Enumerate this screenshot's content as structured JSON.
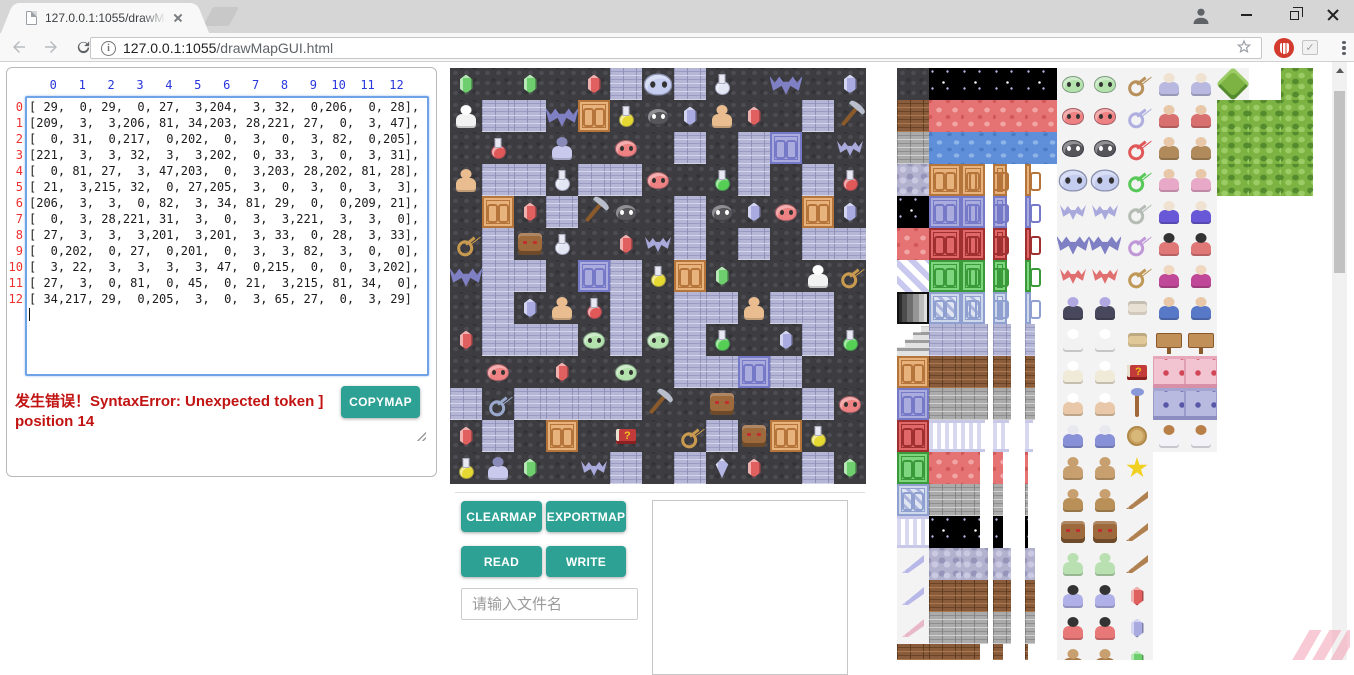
{
  "browser": {
    "tab_title": "127.0.0.1:1055/drawMa",
    "url_host": "127.0.0.1:1055",
    "url_path": "/drawMapGUI.html"
  },
  "left_panel": {
    "col_headers": [
      0,
      1,
      2,
      3,
      4,
      5,
      6,
      7,
      8,
      9,
      10,
      11,
      12
    ],
    "row_headers": [
      0,
      1,
      2,
      3,
      4,
      5,
      6,
      7,
      8,
      9,
      10,
      11,
      12
    ],
    "error_text": "发生错误！SyntaxError: Unexpected token ] position 14",
    "copymap_label": "COPYMAP"
  },
  "controls": {
    "clearmap_label": "CLEARMAP",
    "exportmap_label": "EXPORTMAP",
    "read_label": "READ",
    "write_label": "WRITE",
    "filename_placeholder": "请输入文件名"
  },
  "colors": {
    "accent_teal": "#2ea195",
    "error_red": "#c21313",
    "col_header_blue": "#2936dd",
    "row_header_red": "#ee2f2f"
  },
  "map": {
    "matrix": [
      [
        29,
        0,
        29,
        0,
        27,
        3,
        204,
        3,
        32,
        0,
        206,
        0,
        28
      ],
      [
        209,
        3,
        3,
        206,
        81,
        34,
        203,
        28,
        221,
        27,
        0,
        3,
        47
      ],
      [
        0,
        31,
        0,
        217,
        0,
        202,
        0,
        3,
        0,
        3,
        82,
        0,
        205
      ],
      [
        221,
        3,
        3,
        32,
        3,
        3,
        202,
        0,
        33,
        3,
        0,
        3,
        31
      ],
      [
        0,
        81,
        27,
        3,
        47,
        203,
        0,
        3,
        203,
        28,
        202,
        81,
        28
      ],
      [
        21,
        3,
        215,
        32,
        0,
        27,
        205,
        3,
        0,
        3,
        0,
        3,
        3
      ],
      [
        206,
        3,
        3,
        0,
        82,
        3,
        34,
        81,
        29,
        0,
        0,
        209,
        21
      ],
      [
        0,
        3,
        28,
        221,
        31,
        3,
        0,
        3,
        3,
        221,
        3,
        3,
        0
      ],
      [
        27,
        3,
        3,
        3,
        201,
        3,
        201,
        3,
        33,
        0,
        28,
        3,
        33
      ],
      [
        0,
        202,
        0,
        27,
        0,
        201,
        0,
        3,
        3,
        82,
        3,
        0,
        0
      ],
      [
        3,
        22,
        3,
        3,
        3,
        3,
        47,
        0,
        215,
        0,
        0,
        3,
        202
      ],
      [
        27,
        3,
        0,
        81,
        0,
        45,
        0,
        21,
        3,
        215,
        81,
        34,
        0
      ],
      [
        34,
        217,
        29,
        0,
        205,
        3,
        0,
        3,
        65,
        27,
        0,
        3,
        29
      ]
    ],
    "legend": {
      "0": {
        "g": "floor",
        "name": "dark-floor"
      },
      "3": {
        "g": "wall",
        "name": "brick-wall"
      },
      "21": {
        "s": "key",
        "c": "#c89a50",
        "name": "yellow-key"
      },
      "22": {
        "s": "key",
        "c": "#9aa8cc",
        "name": "blue-key"
      },
      "27": {
        "s": "gem",
        "c": "#e06060",
        "name": "red-gem"
      },
      "28": {
        "s": "gem",
        "c": "#a8aae0",
        "name": "blue-gem"
      },
      "29": {
        "s": "gem",
        "c": "#6ece6e",
        "name": "green-gem"
      },
      "31": {
        "s": "flask",
        "c": "#e05858",
        "name": "red-potion"
      },
      "32": {
        "s": "flask",
        "c": "#e3e7f4",
        "name": "silver-potion"
      },
      "33": {
        "s": "flask",
        "c": "#55d055",
        "name": "green-potion"
      },
      "34": {
        "s": "flask",
        "c": "#e6d832",
        "name": "yellow-potion"
      },
      "45": {
        "s": "book",
        "name": "magic-book"
      },
      "47": {
        "s": "pick",
        "name": "pickaxe"
      },
      "65": {
        "s": "top",
        "c": "#b4b6e4",
        "name": "spinner-item"
      },
      "81": {
        "d": "tan",
        "name": "orange-door"
      },
      "82": {
        "d": "lav",
        "name": "blue-door"
      },
      "201": {
        "s": "slime",
        "c": "#b4e2ac",
        "e": "#333333",
        "name": "green-slime"
      },
      "202": {
        "s": "slime",
        "c": "#ee8282",
        "e": "#333333",
        "name": "red-slime"
      },
      "203": {
        "s": "slime",
        "c": "#55555a",
        "e": "#ffffff",
        "name": "black-slime"
      },
      "204": {
        "s": "slime",
        "c": "#c4cdf0",
        "e": "#333333",
        "big": 1,
        "name": "big-slime"
      },
      "205": {
        "s": "bat",
        "c": "#a9a9dc",
        "name": "small-bat"
      },
      "206": {
        "s": "bat",
        "c": "#7f7fc4",
        "big": 1,
        "name": "big-bat"
      },
      "209": {
        "s": "person",
        "c": "#f2f2f2",
        "h": "#ffffff",
        "name": "skeleton"
      },
      "215": {
        "s": "face",
        "c": "#9c6a3c",
        "name": "stone-statue"
      },
      "217": {
        "s": "person",
        "c": "#c9c9ee",
        "h": "#8a8ab8",
        "name": "ghost"
      },
      "221": {
        "s": "person",
        "c": "#e9bd8f",
        "h": "#e9bd8f",
        "name": "golem"
      }
    }
  },
  "tileset": {
    "rows": [
      [
        {
          "g": "floor"
        },
        {
          "g": "black"
        },
        {
          "g": "black"
        },
        {
          "g": "black"
        },
        {
          "g": "black"
        },
        {
          "s": "slime",
          "c": "#b4e2ac",
          "e": "#333333"
        },
        {
          "s": "slime",
          "c": "#b4e2ac",
          "e": "#333333"
        },
        {
          "s": "key",
          "c": "#b8905a"
        },
        {
          "s": "person",
          "c": "#b8b8e0",
          "h": "#f0e2d0"
        },
        {
          "s": "person",
          "c": "#b8b8e0",
          "h": "#f0e2d0"
        },
        {
          "s": "treeD"
        },
        null,
        {
          "g": "tree"
        }
      ],
      [
        {
          "g": "bbrick"
        },
        {
          "g": "red"
        },
        {
          "g": "red"
        },
        {
          "g": "red"
        },
        {
          "g": "red"
        },
        {
          "s": "slime",
          "c": "#ee8282",
          "e": "#333333"
        },
        {
          "s": "slime",
          "c": "#ee8282",
          "e": "#333333"
        },
        {
          "s": "key",
          "c": "#b0b0e0"
        },
        {
          "s": "person",
          "c": "#d87070",
          "h": "#e8c8a8"
        },
        {
          "s": "person",
          "c": "#d87070",
          "h": "#e8c8a8"
        },
        {
          "g": "tree"
        },
        {
          "g": "tree"
        },
        {
          "g": "tree"
        }
      ],
      [
        {
          "g": "gstone"
        },
        {
          "g": "water"
        },
        {
          "g": "water"
        },
        {
          "g": "water"
        },
        {
          "g": "water"
        },
        {
          "s": "slime",
          "c": "#55555a",
          "e": "#ffffff"
        },
        {
          "s": "slime",
          "c": "#55555a",
          "e": "#ffffff"
        },
        {
          "s": "key",
          "c": "#e05858"
        },
        {
          "s": "person",
          "c": "#b08a5a",
          "h": "#e8c8a8"
        },
        {
          "s": "person",
          "c": "#b08a5a",
          "h": "#e8c8a8"
        },
        {
          "g": "tree"
        },
        {
          "g": "tree"
        },
        {
          "g": "tree"
        }
      ],
      [
        {
          "g": "lavcob"
        },
        {
          "d": "tan"
        },
        {
          "d": "tan",
          "f": 75
        },
        {
          "d": "tan",
          "f": 45
        },
        {
          "d": "tan",
          "f": 18
        },
        {
          "s": "slime",
          "c": "#c4cdf0",
          "e": "#333333",
          "big": 1
        },
        {
          "s": "slime",
          "c": "#c4cdf0",
          "e": "#333333",
          "big": 1
        },
        {
          "s": "key",
          "c": "#58c858"
        },
        {
          "s": "person",
          "c": "#e8a8c8",
          "h": "#e8c8a8"
        },
        {
          "s": "person",
          "c": "#e8a8c8",
          "h": "#e8c8a8"
        },
        {
          "g": "tree"
        },
        {
          "g": "tree"
        },
        {
          "g": "tree"
        }
      ],
      [
        {
          "g": "black"
        },
        {
          "d": "lav"
        },
        {
          "d": "lav",
          "f": 75
        },
        {
          "d": "lav",
          "f": 45
        },
        {
          "d": "lav",
          "f": 18
        },
        {
          "s": "bat",
          "c": "#a9a9dc"
        },
        {
          "s": "bat",
          "c": "#a9a9dc"
        },
        {
          "s": "key",
          "c": "#b4bcb4"
        },
        {
          "s": "person",
          "c": "#6858d8",
          "h": "#f0e2d0"
        },
        {
          "s": "person",
          "c": "#6858d8",
          "h": "#f0e2d0"
        },
        null,
        null,
        null
      ],
      [
        {
          "g": "red"
        },
        {
          "d": "red"
        },
        {
          "d": "red",
          "f": 75
        },
        {
          "d": "red",
          "f": 45
        },
        {
          "d": "red",
          "f": 18
        },
        {
          "s": "bat",
          "c": "#7f7fc4",
          "big": 1
        },
        {
          "s": "bat",
          "c": "#7f7fc4",
          "big": 1
        },
        {
          "s": "key",
          "c": "#c098d8"
        },
        {
          "s": "person",
          "c": "#e07878",
          "h": "#333333"
        },
        {
          "s": "person",
          "c": "#e07878",
          "h": "#333333"
        },
        null,
        null,
        null
      ],
      [
        {
          "g": "diag"
        },
        {
          "d": "green"
        },
        {
          "d": "green",
          "f": 75
        },
        {
          "d": "green",
          "f": 45
        },
        {
          "d": "green",
          "f": 18
        },
        {
          "s": "bat",
          "c": "#e07070"
        },
        {
          "s": "bat",
          "c": "#e07070"
        },
        {
          "s": "key",
          "c": "#c09858"
        },
        {
          "s": "person",
          "c": "#c04898",
          "h": "#f0d8c0"
        },
        {
          "s": "person",
          "c": "#c04898",
          "h": "#f0d8c0"
        },
        null,
        null,
        null
      ],
      [
        {
          "g": "fade"
        },
        {
          "d": "lat"
        },
        {
          "d": "lat",
          "f": 75
        },
        {
          "d": "lat",
          "f": 45
        },
        {
          "d": "lat",
          "f": 18
        },
        {
          "s": "person",
          "c": "#48485c",
          "h": "#b0a8e0"
        },
        {
          "s": "person",
          "c": "#48485c",
          "h": "#b0a8e0"
        },
        {
          "s": "scroll",
          "c": "#e8e0d2"
        },
        {
          "s": "person",
          "c": "#5878c8",
          "h": "#e8c8a8"
        },
        {
          "s": "person",
          "c": "#5878c8",
          "h": "#e8c8a8"
        },
        null,
        null,
        null
      ],
      [
        {
          "g": "stairs"
        },
        {
          "g": "wall"
        },
        {
          "g": "wall",
          "f": 85
        },
        {
          "g": "wall",
          "f": 55
        },
        {
          "g": "wall",
          "f": 30
        },
        {
          "s": "person",
          "c": "#f2f2f2",
          "h": "#ffffff"
        },
        {
          "s": "person",
          "c": "#f2f2f2",
          "h": "#ffffff"
        },
        {
          "s": "scroll",
          "c": "#e0c898"
        },
        {
          "s": "sign"
        },
        {
          "s": "sign"
        },
        null,
        null,
        null
      ],
      [
        {
          "d": "tan"
        },
        {
          "g": "bbrick"
        },
        {
          "g": "bbrick",
          "f": 85
        },
        {
          "g": "bbrick",
          "f": 55
        },
        {
          "g": "bbrick",
          "f": 30
        },
        {
          "s": "person",
          "c": "#f0ead8",
          "h": "#ffffff"
        },
        {
          "s": "person",
          "c": "#f0ead8",
          "h": "#ffffff"
        },
        {
          "s": "book"
        },
        {
          "g": "pinkw"
        },
        {
          "g": "pinkw"
        },
        null,
        null,
        null
      ],
      [
        {
          "d": "lav"
        },
        {
          "g": "gstone"
        },
        {
          "g": "gstone",
          "f": 85
        },
        {
          "g": "gstone",
          "f": 55
        },
        {
          "g": "gstone",
          "f": 30
        },
        {
          "s": "person",
          "c": "#e8c8a8",
          "h": "#ffffff"
        },
        {
          "s": "person",
          "c": "#e8c8a8",
          "h": "#ffffff"
        },
        {
          "s": "staff"
        },
        {
          "g": "lavw"
        },
        {
          "g": "lavw"
        },
        null,
        null,
        null
      ],
      [
        {
          "d": "red"
        },
        {
          "g": "pillar"
        },
        {
          "g": "pillar",
          "f": 75
        },
        {
          "g": "pillar",
          "f": 50
        },
        {
          "g": "pillar",
          "f": 25
        },
        {
          "s": "person",
          "c": "#8890d8",
          "h": "#e8e8f0"
        },
        {
          "s": "person",
          "c": "#8890d8",
          "h": "#e8e8f0"
        },
        {
          "s": "medal"
        },
        {
          "s": "person",
          "c": "#f2f2f8",
          "h": "#b88048"
        },
        {
          "s": "person",
          "c": "#f2f2f8",
          "h": "#b88048"
        },
        null,
        null,
        null
      ],
      [
        {
          "d": "green"
        },
        {
          "g": "red"
        },
        {
          "g": "red",
          "f": 60
        },
        {
          "g": "red",
          "f": 30
        },
        {
          "g": "red",
          "f": 10
        },
        {
          "s": "person",
          "c": "#c8a070",
          "h": "#c8a070"
        },
        {
          "s": "person",
          "c": "#c8a070",
          "h": "#c8a070"
        },
        {
          "s": "star"
        },
        null,
        null,
        null,
        null,
        null
      ],
      [
        {
          "d": "lat"
        },
        {
          "g": "gstone"
        },
        {
          "g": "gstone",
          "f": 60
        },
        {
          "g": "gstone",
          "f": 30
        },
        {
          "g": "gstone",
          "f": 10
        },
        {
          "s": "person",
          "c": "#b89058",
          "h": "#c8a070"
        },
        {
          "s": "person",
          "c": "#b89058",
          "h": "#c8a070"
        },
        {
          "s": "wing",
          "c": "#b08050"
        },
        null,
        null,
        null,
        null,
        null
      ],
      [
        {
          "g": "pillar"
        },
        {
          "g": "black"
        },
        {
          "g": "black",
          "f": 60
        },
        {
          "g": "black",
          "f": 30
        },
        {
          "g": "black",
          "f": 10
        },
        {
          "s": "face",
          "c": "#9c6a3c"
        },
        {
          "s": "face",
          "c": "#9c6a3c"
        },
        {
          "s": "wing",
          "c": "#b08050"
        },
        null,
        null,
        null,
        null,
        null
      ],
      [
        {
          "s": "wing",
          "c": "#b8b8e8"
        },
        {
          "g": "lavcob"
        },
        {
          "g": "lavcob",
          "f": 85
        },
        {
          "g": "lavcob",
          "f": 55
        },
        {
          "g": "lavcob",
          "f": 30
        },
        {
          "s": "person",
          "c": "#b8e0b0",
          "h": "#b8e0b0"
        },
        {
          "s": "person",
          "c": "#b8e0b0",
          "h": "#b8e0b0"
        },
        {
          "s": "wing",
          "c": "#b08050"
        },
        null,
        null,
        null,
        null,
        null
      ],
      [
        {
          "s": "wing",
          "c": "#b8b8e8"
        },
        {
          "g": "bbrick"
        },
        {
          "g": "bbrick",
          "f": 85
        },
        {
          "g": "bbrick",
          "f": 55
        },
        {
          "g": "bbrick",
          "f": 30
        },
        {
          "s": "person",
          "c": "#b0b0e8",
          "h": "#333333"
        },
        {
          "s": "person",
          "c": "#b0b0e8",
          "h": "#333333"
        },
        {
          "s": "gem",
          "c": "#e06060"
        },
        null,
        null,
        null,
        null,
        null
      ],
      [
        {
          "s": "wing",
          "c": "#e8b8c8"
        },
        {
          "g": "gstone"
        },
        {
          "g": "gstone",
          "f": 85
        },
        {
          "g": "gstone",
          "f": 55
        },
        {
          "g": "gstone",
          "f": 30
        },
        {
          "s": "person",
          "c": "#e87878",
          "h": "#333333"
        },
        {
          "s": "person",
          "c": "#e87878",
          "h": "#333333"
        },
        {
          "s": "gem",
          "c": "#a8aae0"
        },
        null,
        null,
        null,
        null,
        null
      ],
      [
        {
          "g": "bbrick"
        },
        {
          "g": "bbrick"
        },
        {
          "g": "bbrick",
          "f": 60
        },
        {
          "g": "bbrick",
          "f": 30
        },
        {
          "g": "bbrick",
          "f": 10
        },
        {
          "s": "person",
          "c": "#a87848",
          "h": "#c8a070"
        },
        {
          "s": "person",
          "c": "#a87848",
          "h": "#c8a070"
        },
        {
          "s": "gem",
          "c": "#6ece6e"
        },
        null,
        null,
        null,
        null,
        null
      ]
    ]
  }
}
